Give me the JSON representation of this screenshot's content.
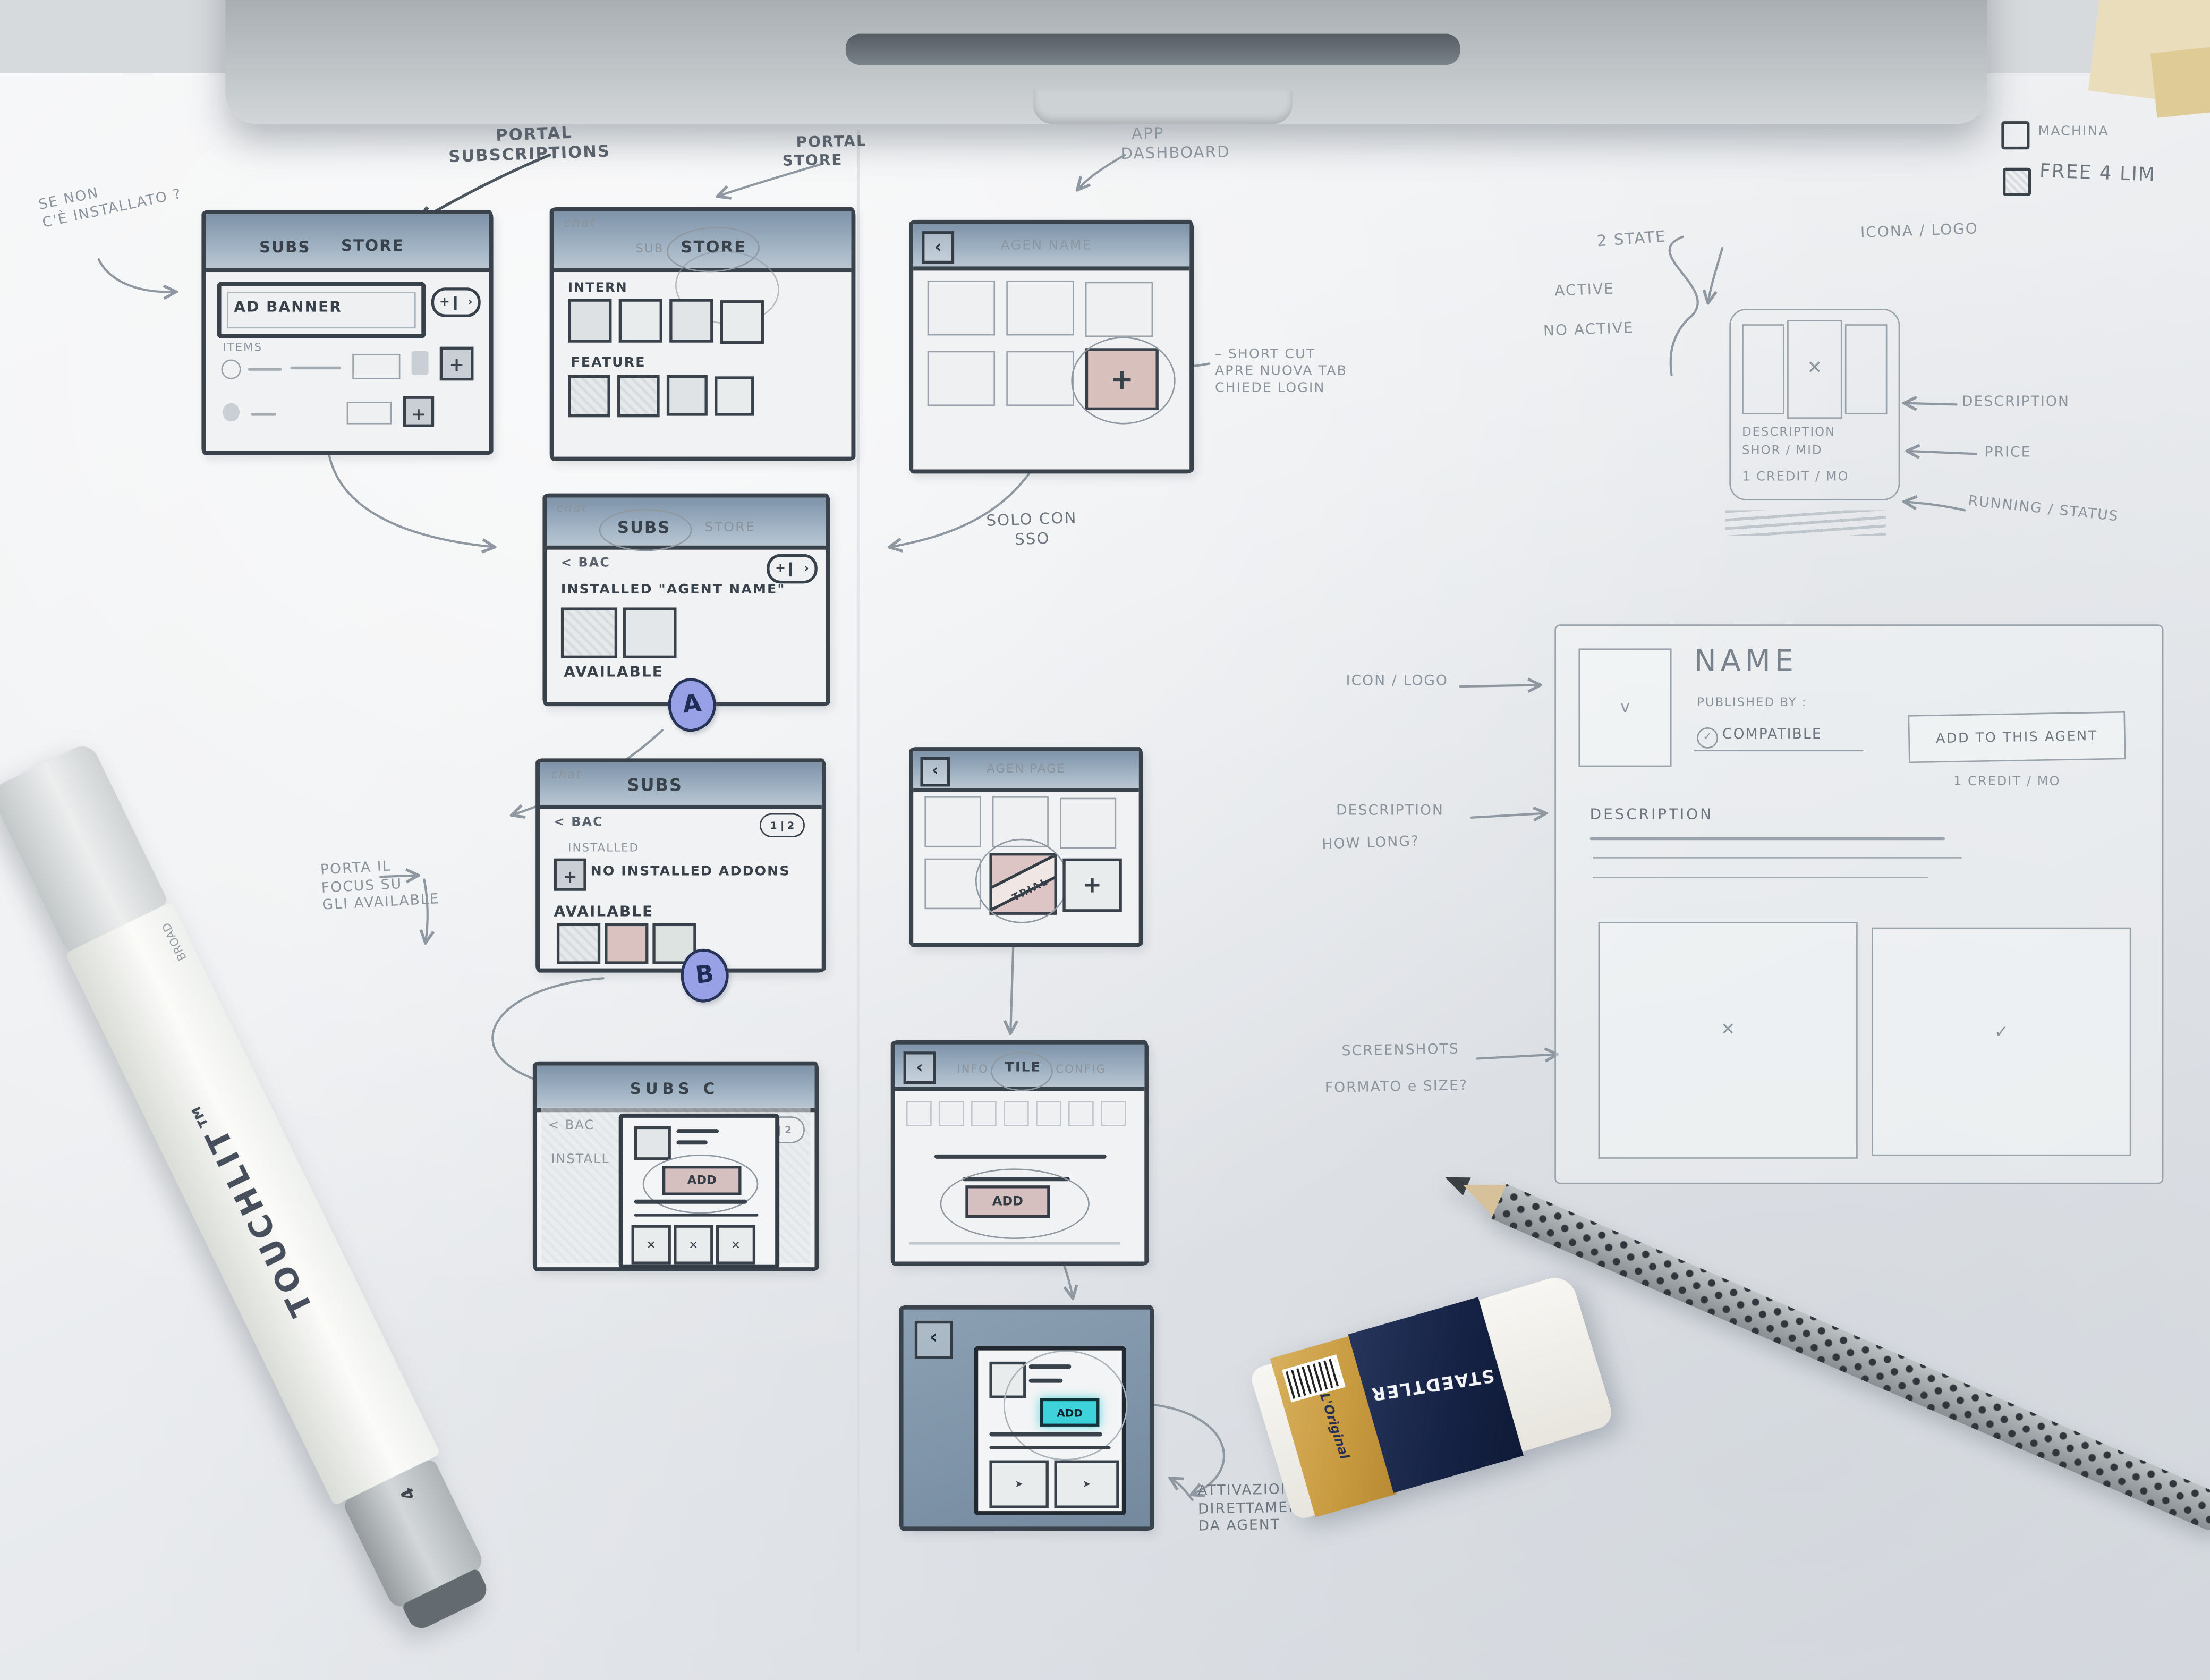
{
  "colors": {
    "header_blue": "#94a9bd",
    "accent_pink": "#d9c2c0",
    "accent_cyan": "#3ed2da",
    "badge_purple": "#98a0e6",
    "ink": "#39414b",
    "pencil": "#8b949d",
    "paper": "#edeff1"
  },
  "ui": {
    "plus": "+",
    "chev": "›",
    "back": "‹",
    "x": "✕",
    "check": "✓",
    "tick": "v",
    "cursor": "➤",
    "pager": "1 | 2"
  },
  "notes": {
    "portal_subscriptions": "PORTAL\nSUBSCRIPTIONS",
    "se_non_installed": "SE NON\nC'È INSTALLATO ?",
    "portal_store": "PORTAL\nSTORE",
    "app_dashboard": "APP\nDASHBOARD",
    "shortcut": "– SHORT CUT\nAPRE NUOVA TAB\nCHIEDE LOGIN",
    "solo_con_sso": "SOLO CON\nSSO",
    "porta_focus": "PORTA IL\nFOCUS SU\nGLI AVAILABLE",
    "attivazione": "ATTIVAZIONE\nDIRETTAMENTE\nDA AGENT",
    "two_state": "2 STATE",
    "state_active": "ACTIVE",
    "state_no_active": "NO ACTIVE",
    "icona_logo": "ICONA / LOGO",
    "tile_description": "DESCRIPTION",
    "tile_price": "PRICE",
    "tile_running": "RUNNING / STATUS",
    "detail_icon_logo": "ICON / LOGO",
    "detail_description": "DESCRIPTION",
    "detail_how_long": "HOW LONG?",
    "detail_screenshots": "SCREENSHOTS",
    "detail_format": "FORMATO e SIZE?"
  },
  "checks": {
    "machina": "MACHINA",
    "free": "FREE 4 LIM"
  },
  "wf_subs_store": {
    "tab_subs": "SUBS",
    "tab_store": "STORE",
    "ad_banner": "AD BANNER",
    "items_label": "ITEMS"
  },
  "wf_portal_store": {
    "corner": "chat",
    "tab_sub": "SUB",
    "tab_store": "STORE",
    "section_intern": "INTERN",
    "section_feature": "FEATURE"
  },
  "wf_app_dashboard": {
    "title": "AGEN NAME"
  },
  "wf_installed": {
    "corner": "chat",
    "tab_subs": "SUBS",
    "tab_store": "STORE",
    "back": "< BAC",
    "installed": "INSTALLED \"AGENT NAME\"",
    "available": "AVAILABLE",
    "badge": "A"
  },
  "wf_empty": {
    "corner": "chat",
    "tab_subs": "SUBS",
    "back": "< BAC",
    "installed_label": "INSTALLED",
    "no_addons": "NO INSTALLED ADDONS",
    "available": "AVAILABLE",
    "badge": "B"
  },
  "wf_agent_page": {
    "title": "AGEN PAGE",
    "ribbon": "TRIAL"
  },
  "wf_subs_detail": {
    "title": "SUBS C",
    "back": "< BAC",
    "install": "INSTALL",
    "add": "ADD"
  },
  "wf_tile_config": {
    "tab_info": "INFO",
    "tab_tile": "TILE",
    "tab_config": "CONFIG",
    "add": "ADD"
  },
  "wf_modal": {
    "add": "ADD"
  },
  "tile_card": {
    "description": "DESCRIPTION",
    "duration": "SHOR / MID",
    "price": "1 CREDIT / MO"
  },
  "detail_page": {
    "name": "NAME",
    "published": "PUBLISHED BY :",
    "compatible": "COMPATIBLE",
    "add_button": "ADD TO THIS AGENT",
    "price": "1 CREDIT / MO",
    "description": "DESCRIPTION"
  },
  "objects": {
    "marker_brand": "TOUCHLIT™",
    "marker_label": "BROAD",
    "marker_size": "4",
    "eraser_brand": "STAEDTLER",
    "eraser_line": "L'Original"
  }
}
